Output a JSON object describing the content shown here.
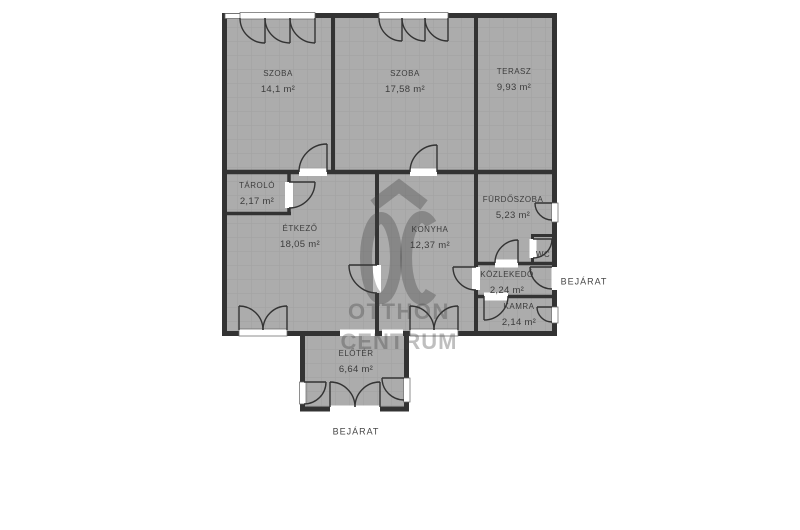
{
  "floorplan": {
    "rooms": [
      {
        "name": "SZOBA",
        "area": "14,1 m²"
      },
      {
        "name": "SZOBA",
        "area": "17,58 m²"
      },
      {
        "name": "TERASZ",
        "area": "9,93 m²"
      },
      {
        "name": "TÁROLÓ",
        "area": "2,17 m²"
      },
      {
        "name": "ÉTKEZŐ",
        "area": "18,05 m²"
      },
      {
        "name": "KONYHA",
        "area": "12,37 m²"
      },
      {
        "name": "FÜRDŐSZOBA",
        "area": "5,23 m²"
      },
      {
        "name": "WC",
        "area": ""
      },
      {
        "name": "KÖZLEKEDŐ",
        "area": "2,24 m²"
      },
      {
        "name": "KAMRA",
        "area": "2,14 m²"
      },
      {
        "name": "ELŐTÉR",
        "area": "6,64 m²"
      }
    ],
    "entrance_labels": {
      "right": "BEJÁRAT",
      "bottom": "BEJÁRAT"
    },
    "watermark": {
      "logo_text": "OC",
      "line1": "OTTHON",
      "line2": "CENTRUM"
    },
    "colors": {
      "background": "#ffffff",
      "room_fill": "#acacac",
      "grid_line": "#a1a1a1",
      "wall": "#333333",
      "label_text": "#3c3c3c",
      "watermark": "rgba(60,60,60,0.33)"
    }
  }
}
